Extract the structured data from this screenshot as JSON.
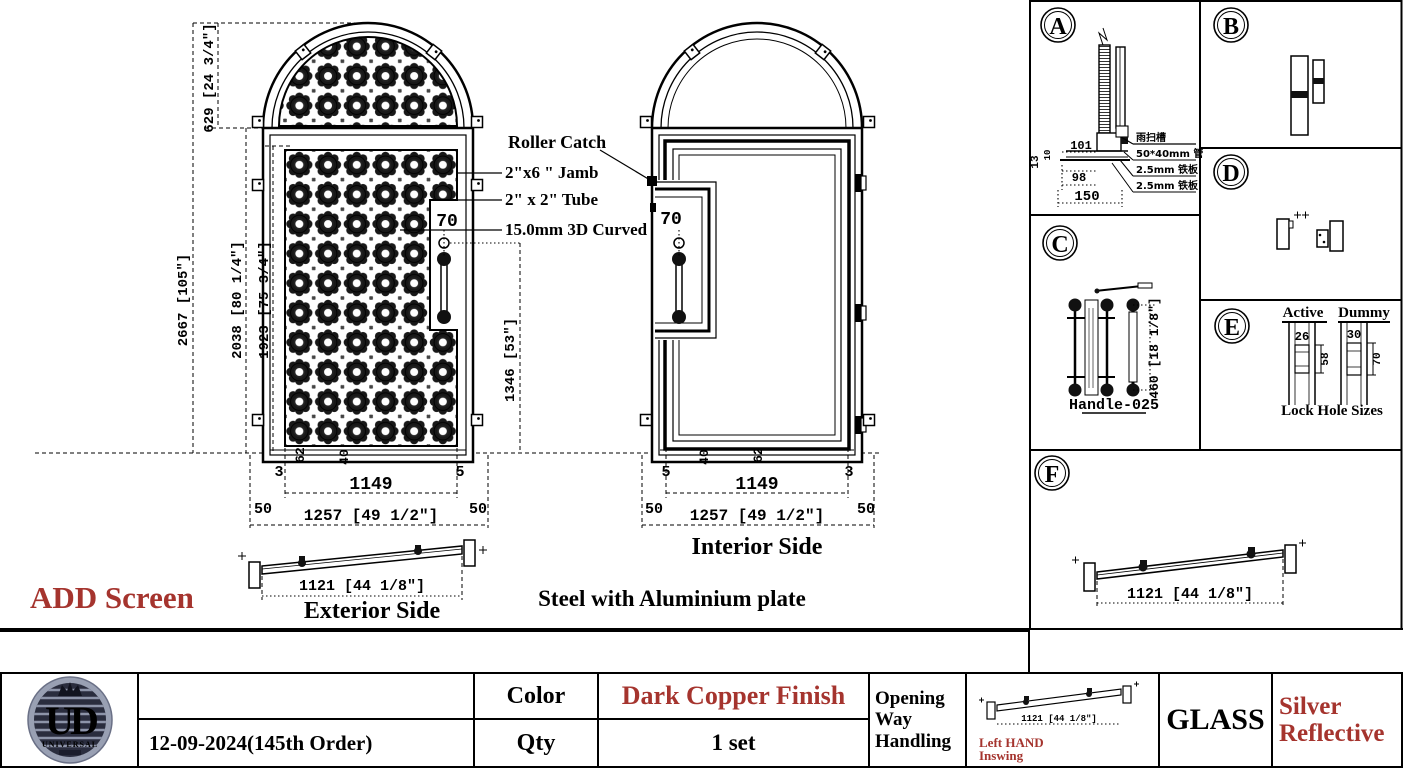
{
  "colors": {
    "accent_red": "#a5342e",
    "line": "#000000"
  },
  "notices": {
    "line1": "Production Lead time will not start until CAD is Approved!",
    "line2": "ALL DOOR SWINGS NEED TO BE CHECK BY CUSTOMER IT IS NOT U.I.D FAULT IF THE SWING IS  INCORRECT"
  },
  "annotations": {
    "add_screen": "ADD Screen",
    "roller_catch": "Roller Catch",
    "jamb": "2\"x6 \" Jamb",
    "tube": "2\" x 2\" Tube",
    "curved": "15.0mm  3D Curved",
    "material": "Steel with Aluminium plate"
  },
  "exterior": {
    "caption": "Exterior Side",
    "dim_total_height": "2667 [105\"]",
    "dim_2038": "2038 [80 1/4\"]",
    "dim_1923": "1923 [75 3/4\"]",
    "dim_arch": "629 [24 3/4\"]",
    "dim_handle": "1346 [53\"]",
    "dim_width_inner": "1149",
    "dim_width_outer": "1257 [49 1/2\"]",
    "dim_jamb_left": "50",
    "dim_jamb_right": "50",
    "dim_3": "3",
    "dim_5": "5",
    "dim_62": "62",
    "dim_40": "40",
    "dim_70": "70",
    "dim_sill": "1121 [44 1/8\"]"
  },
  "interior": {
    "caption": "Interior Side",
    "dim_width_inner": "1149",
    "dim_width_outer": "1257 [49 1/2\"]",
    "dim_jamb_left": "50",
    "dim_jamb_right": "50",
    "dim_3": "3",
    "dim_5": "5",
    "dim_62": "62",
    "dim_40": "40",
    "dim_70": "70"
  },
  "details": {
    "a": {
      "letter": "A",
      "dim_13": "13",
      "dim_10": "10",
      "dim_101": "101",
      "dim_98": "98",
      "dim_150": "150",
      "label_1": "雨扫槽",
      "label_2": "50*40mm 管",
      "label_3": "2.5mm 铁板",
      "label_4": "2.5mm 铁板"
    },
    "b": {
      "letter": "B"
    },
    "c": {
      "letter": "C",
      "handle_name": "Handle-025",
      "dim_height": "460 [18 1/8\"]"
    },
    "d": {
      "letter": "D"
    },
    "e": {
      "letter": "E",
      "active_label": "Active",
      "dummy_label": "Dummy",
      "caption": "Lock Hole Sizes",
      "active_width": "26",
      "active_height": "58",
      "dummy_width": "30",
      "dummy_height": "70"
    },
    "f": {
      "letter": "F",
      "dim_length": "1121 [44 1/8\"]"
    }
  },
  "title_block": {
    "logo": {
      "monogram": "UD",
      "name": "UNIVERSAL"
    },
    "date_order": "12-09-2024(145th Order)",
    "color_label": "Color",
    "color_value": "Dark Copper Finish",
    "qty_label": "Qty",
    "qty_value": "1 set",
    "opening_line1": "Opening",
    "opening_line2": "Way",
    "opening_line3": "Handling",
    "swing_dim": "1121 [44 1/8\"]",
    "swing_line1": "Left HAND",
    "swing_line2": "Inswing",
    "glass_label": "GLASS",
    "glass_line1": "Silver",
    "glass_line2": "Reflective"
  }
}
